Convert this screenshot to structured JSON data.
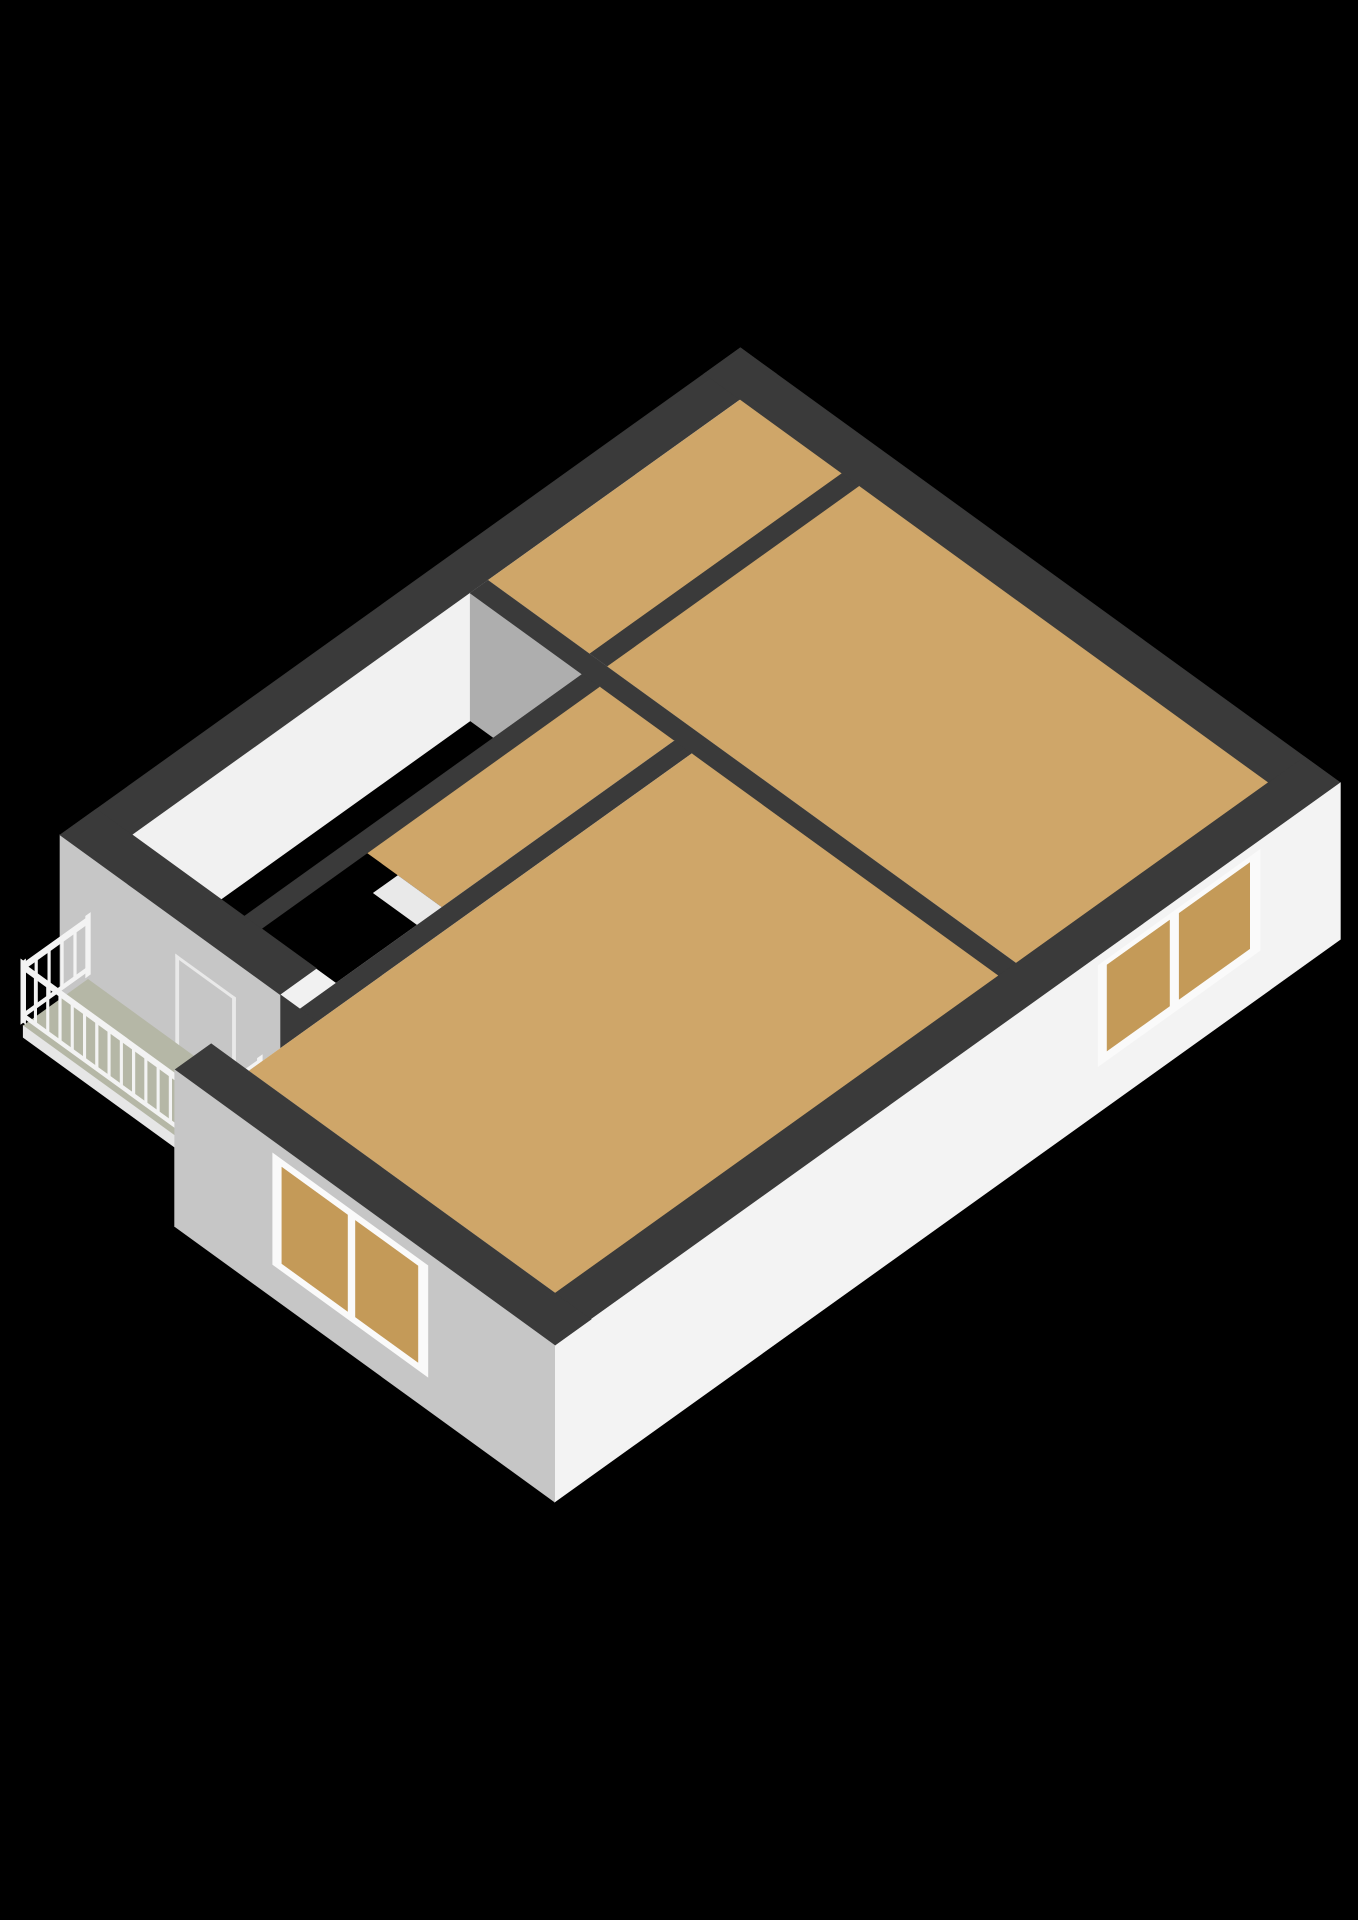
{
  "scene": {
    "kind": "isometric-3d-floorplan",
    "background": "#000000",
    "colors": {
      "band": "#3a3a3a",
      "faceSE": "#f1f1f1",
      "faceSEbright": "#f3f3f3",
      "faceSW": "#c6c6c6",
      "faceNE": "#c7c7c7",
      "faceNW": "#ececec",
      "faceStep": "#dfdfdf",
      "faceShadow": "#aeaeae",
      "floor": "#cfa669",
      "tanOpen": "#c49a58",
      "balcony": "#b5b7a6",
      "fascia": "#e6e6e6",
      "frame": "#fafafa",
      "glass": "#070707",
      "tread": "#e9e9e9",
      "riser": "#f8f8f8",
      "rail": "#f3f3f3",
      "void": "#000000",
      "doorLine": "#ffffff",
      "doorLineSoft": "#e9e9e9",
      "handle": "#8f8f8f"
    },
    "projection": {
      "ox": 60,
      "oy": 835,
      "ux": 81,
      "uy": -58,
      "vx": 80,
      "vy": 58,
      "hs": 58,
      "top": 2.2,
      "slab": -0.5
    },
    "elements": [
      {
        "n": "wall-top-band-nw",
        "t": "band",
        "x": [
          0,
          8.4
        ],
        "y": [
          0,
          0.45
        ],
        "c": "band"
      },
      {
        "n": "wall-face-nw-inner",
        "t": "uface",
        "y": 0.45,
        "x": [
          0.45,
          7.95
        ],
        "z": [
          0,
          2.2
        ],
        "c": "faceSE"
      },
      {
        "n": "wall-face-ne-inner",
        "t": "vface",
        "x": 7.95,
        "y": [
          0.45,
          7.05
        ],
        "z": [
          0,
          2.2
        ],
        "c": "faceNE"
      },
      {
        "n": "window-small-frame",
        "t": "vface",
        "x": 7.94,
        "y": [
          0.67,
          1.53
        ],
        "z": [
          0.4,
          1.88
        ],
        "c": "frame"
      },
      {
        "n": "window-small-glass",
        "t": "vface",
        "x": 7.93,
        "y": [
          0.77,
          1.43
        ],
        "z": [
          0.52,
          1.78
        ],
        "c": "glass"
      },
      {
        "n": "window-large-frame",
        "t": "vface",
        "x": 7.94,
        "y": [
          3.42,
          5.48
        ],
        "z": [
          0.12,
          1.92
        ],
        "c": "frame"
      },
      {
        "n": "window-large-glass-left",
        "t": "vface",
        "x": 7.93,
        "y": [
          3.54,
          4.41
        ],
        "z": [
          0.26,
          1.8
        ],
        "c": "glass"
      },
      {
        "n": "window-large-glass-right",
        "t": "vface",
        "x": 7.93,
        "y": [
          4.49,
          5.36
        ],
        "z": [
          0.26,
          1.8
        ],
        "c": "glass"
      },
      {
        "n": "wall-top-band-ne",
        "t": "band",
        "x": [
          7.95,
          8.4
        ],
        "y": [
          0,
          7.5
        ],
        "c": "band"
      },
      {
        "n": "room-top-floor",
        "t": "floor",
        "x": [
          4.84,
          7.95
        ],
        "y": [
          0.45,
          1.72
        ],
        "z": 0,
        "c": "floor"
      },
      {
        "n": "wall-face-w3-se",
        "t": "uface",
        "y": 1.94,
        "x": [
          4.84,
          7.95
        ],
        "z": [
          0,
          2.2
        ],
        "c": "faceSE"
      },
      {
        "n": "wall-top-band-w3",
        "t": "band",
        "x": [
          4.84,
          7.95
        ],
        "y": [
          1.72,
          1.94
        ],
        "c": "band"
      },
      {
        "n": "room-big-floor",
        "t": "floor",
        "x": [
          4.84,
          7.95
        ],
        "y": [
          1.94,
          7.05
        ],
        "z": 0,
        "c": "floor"
      },
      {
        "n": "wall-face-spine-ne",
        "t": "vface",
        "x": 4.84,
        "y": [
          0.45,
          7.05
        ],
        "z": [
          0,
          2.2
        ],
        "c": "faceNE"
      },
      {
        "n": "wall-face-spine-sw",
        "t": "vface",
        "x": 4.62,
        "y": [
          0.45,
          7.05
        ],
        "z": [
          0,
          2.2
        ],
        "c": "faceShadow"
      },
      {
        "n": "door-hall-a-jamb1",
        "t": "vface",
        "x": 4.615,
        "y": [
          2.25,
          2.29
        ],
        "z": [
          0,
          1.56
        ],
        "c": "doorLine"
      },
      {
        "n": "door-hall-a-jamb2",
        "t": "vface",
        "x": 4.615,
        "y": [
          2.96,
          3.0
        ],
        "z": [
          0,
          1.56
        ],
        "c": "doorLine"
      },
      {
        "n": "door-hall-a-lintel",
        "t": "vface",
        "x": 4.615,
        "y": [
          2.25,
          3.0
        ],
        "z": [
          1.52,
          1.56
        ],
        "c": "doorLine"
      },
      {
        "n": "door-hall-b-jamb1",
        "t": "vface",
        "x": 4.615,
        "y": [
          3.45,
          3.49
        ],
        "z": [
          0,
          1.56
        ],
        "c": "doorLine"
      },
      {
        "n": "door-hall-b-jamb2",
        "t": "vface",
        "x": 4.615,
        "y": [
          4.16,
          4.2
        ],
        "z": [
          0,
          1.56
        ],
        "c": "doorLine"
      },
      {
        "n": "door-hall-b-lintel",
        "t": "vface",
        "x": 4.615,
        "y": [
          3.45,
          4.2
        ],
        "z": [
          1.52,
          1.56
        ],
        "c": "doorLine"
      },
      {
        "n": "wall-top-band-spine",
        "t": "band",
        "x": [
          4.62,
          4.84
        ],
        "y": [
          0.45,
          7.05
        ],
        "c": "band"
      },
      {
        "n": "wall-face-w1-se",
        "t": "uface",
        "y": 2.07,
        "x": [
          0.45,
          4.62
        ],
        "z": [
          0,
          2.2
        ],
        "c": "faceSE"
      },
      {
        "n": "wall-top-band-w1",
        "t": "band",
        "x": [
          0.45,
          4.62
        ],
        "y": [
          1.85,
          2.07
        ],
        "c": "band"
      },
      {
        "n": "landing-floor",
        "t": "floor",
        "x": [
          1.75,
          4.62
        ],
        "y": [
          2.07,
          3.0
        ],
        "z": 0,
        "c": "floor"
      },
      {
        "n": "stairwell-void",
        "t": "floor",
        "x": [
          0.45,
          1.75
        ],
        "y": [
          2.07,
          3.0
        ],
        "z": 0,
        "c": "void"
      },
      {
        "n": 6,
        "t": "stairs",
        "px": [
          1.45,
          1.75
        ],
        "y": [
          2.45,
          3.0
        ],
        "dx": 0.16,
        "dz": 0.28,
        "c": "tread",
        "cr": "riser"
      },
      {
        "n": "wall-face-w6-nw",
        "t": "uface",
        "y": 3.0,
        "x": [
          0,
          4.62
        ],
        "z": [
          0,
          2.2
        ],
        "c": "faceNW"
      },
      {
        "n": "door-bottomroom-jamb1",
        "t": "uface",
        "y": 2.995,
        "x": [
          1.52,
          1.56
        ],
        "z": [
          0,
          1.62
        ],
        "c": "doorLine"
      },
      {
        "n": "door-bottomroom-jamb2",
        "t": "uface",
        "y": 2.995,
        "x": [
          2.28,
          2.32
        ],
        "z": [
          0,
          1.62
        ],
        "c": "doorLine"
      },
      {
        "n": "door-bottomroom-lintel",
        "t": "uface",
        "y": 2.995,
        "x": [
          1.52,
          2.32
        ],
        "z": [
          1.58,
          1.62
        ],
        "c": "doorLine"
      },
      {
        "n": "door-handle",
        "t": "dot",
        "p": [
          1.66,
          2.995,
          0.95
        ],
        "r": 4,
        "c": "handle"
      },
      {
        "n": "stair-railing",
        "t": "railS",
        "y": 3.02,
        "x": [
          0.45,
          1.95
        ],
        "zt": [
          0.3,
          1.1
        ],
        "bal": 9,
        "c": "rail"
      },
      {
        "n": "wall-top-band-w6",
        "t": "band",
        "x": [
          0,
          4.62
        ],
        "y": [
          3.0,
          3.22
        ],
        "c": "band"
      },
      {
        "n": "wall-face-step-nw",
        "t": "uface",
        "y": 2.75,
        "x": [
          -1.3,
          0
        ],
        "z": [
          -0.5,
          2.2
        ],
        "c": "faceStep"
      },
      {
        "n": "wall-top-band-step",
        "t": "band",
        "x": [
          -1.3,
          0
        ],
        "y": [
          2.75,
          3.22
        ],
        "c": "band"
      },
      {
        "n": "wall-face-sw-upper",
        "t": "vface",
        "x": 0,
        "y": [
          0,
          2.75
        ],
        "z": [
          -0.5,
          2.2
        ],
        "c": "faceSW"
      },
      {
        "n": "balcony-door-jamb1",
        "t": "vface",
        "x": -0.005,
        "y": [
          1.45,
          1.49
        ],
        "z": [
          -0.3,
          1.6
        ],
        "c": "doorLineSoft"
      },
      {
        "n": "balcony-door-jamb2",
        "t": "vface",
        "x": -0.005,
        "y": [
          2.16,
          2.2
        ],
        "z": [
          -0.3,
          1.6
        ],
        "c": "doorLineSoft"
      },
      {
        "n": "balcony-door-lintel",
        "t": "vface",
        "x": -0.005,
        "y": [
          1.45,
          2.2
        ],
        "z": [
          1.55,
          1.6
        ],
        "c": "doorLineSoft"
      },
      {
        "n": "wall-top-band-sw-upper",
        "t": "band",
        "x": [
          0,
          0.45
        ],
        "y": [
          0,
          2.75
        ],
        "c": "band"
      },
      {
        "n": "balcony-floor",
        "t": "floor",
        "x": [
          -0.8,
          0
        ],
        "y": [
          0.35,
          2.65
        ],
        "z": 0.06,
        "c": "balcony"
      },
      {
        "n": "balcony-fascia-sw",
        "t": "vface",
        "x": -0.8,
        "y": [
          0.35,
          2.65
        ],
        "z": [
          -0.14,
          0.06
        ],
        "c": "fascia"
      },
      {
        "n": "balcony-fascia-se",
        "t": "uface",
        "y": 2.65,
        "x": [
          -0.8,
          0
        ],
        "z": [
          -0.14,
          0.06
        ],
        "c": "fascia"
      },
      {
        "n": "balcony-railing-nw",
        "t": "railU",
        "y": 0.35,
        "x": [
          -0.8,
          0
        ],
        "zt": [
          1.02,
          1.14
        ],
        "zb": [
          0.2,
          0.28
        ],
        "sp": 0.15,
        "c": "rail"
      },
      {
        "n": "balcony-railing-sw",
        "t": "railV",
        "x": -0.8,
        "y": [
          0.35,
          2.65
        ],
        "zt": [
          1.02,
          1.14
        ],
        "zb": [
          0.2,
          0.28
        ],
        "sp": 0.15,
        "c": "rail"
      },
      {
        "n": "balcony-railing-se",
        "t": "railU",
        "y": 2.65,
        "x": [
          -0.8,
          -0.15
        ],
        "zt": [
          1.02,
          1.14
        ],
        "zb": [
          0.2,
          0.28
        ],
        "sp": 0.15,
        "c": "rail"
      },
      {
        "n": "wall-face-w6-se",
        "t": "uface",
        "y": 3.22,
        "x": [
          -0.85,
          4.62
        ],
        "z": [
          0,
          2.2
        ],
        "c": "faceSE"
      },
      {
        "n": "room-bottom-floor",
        "t": "floor",
        "x": [
          -0.85,
          4.62
        ],
        "y": [
          3.22,
          7.05
        ],
        "z": 0,
        "c": "floor"
      },
      {
        "n": "wall-face-sw-lower-inner",
        "t": "vface",
        "x": -0.85,
        "y": [
          3.1,
          7.05
        ],
        "z": [
          0,
          2.2
        ],
        "c": "faceNE"
      },
      {
        "n": "wall-top-band-se",
        "t": "band",
        "x": [
          -1.3,
          8.4
        ],
        "y": [
          7.05,
          7.5
        ],
        "c": "band"
      },
      {
        "n": "wall-face-se-outer",
        "t": "uface",
        "y": 7.5,
        "x": [
          -1.3,
          8.4
        ],
        "z": [
          -0.5,
          2.2
        ],
        "c": "faceSEbright"
      },
      {
        "n": "window-se-frame",
        "t": "uface",
        "y": 7.49,
        "x": [
          5.42,
          7.42
        ],
        "z": [
          0.28,
          2.02
        ],
        "c": "frame"
      },
      {
        "n": "window-se-open-left",
        "t": "uface",
        "y": 7.48,
        "x": [
          5.54,
          6.31
        ],
        "z": [
          0.42,
          1.9
        ],
        "c": "tanOpen"
      },
      {
        "n": "window-se-open-right",
        "t": "uface",
        "y": 7.48,
        "x": [
          6.43,
          7.3
        ],
        "z": [
          0.42,
          1.9
        ],
        "c": "tanOpen"
      },
      {
        "n": "wall-top-band-sw-lower",
        "t": "band",
        "x": [
          -1.3,
          -0.85
        ],
        "y": [
          2.75,
          7.5
        ],
        "c": "band"
      },
      {
        "n": "wall-face-sw-lower-outer",
        "t": "vface",
        "x": -1.3,
        "y": [
          2.75,
          7.5
        ],
        "z": [
          -0.5,
          2.2
        ],
        "c": "faceSW"
      },
      {
        "n": "window-sw-frame",
        "t": "vface",
        "x": -1.305,
        "y": [
          3.98,
          5.92
        ],
        "z": [
          0.08,
          2.0
        ],
        "c": "frame"
      },
      {
        "n": "window-sw-open-left",
        "t": "vface",
        "x": -1.31,
        "y": [
          4.1,
          4.92
        ],
        "z": [
          0.22,
          1.88
        ],
        "c": "tanOpen"
      },
      {
        "n": "window-sw-open-right",
        "t": "vface",
        "x": -1.31,
        "y": [
          5.02,
          5.8
        ],
        "z": [
          0.22,
          1.88
        ],
        "c": "tanOpen"
      }
    ]
  }
}
